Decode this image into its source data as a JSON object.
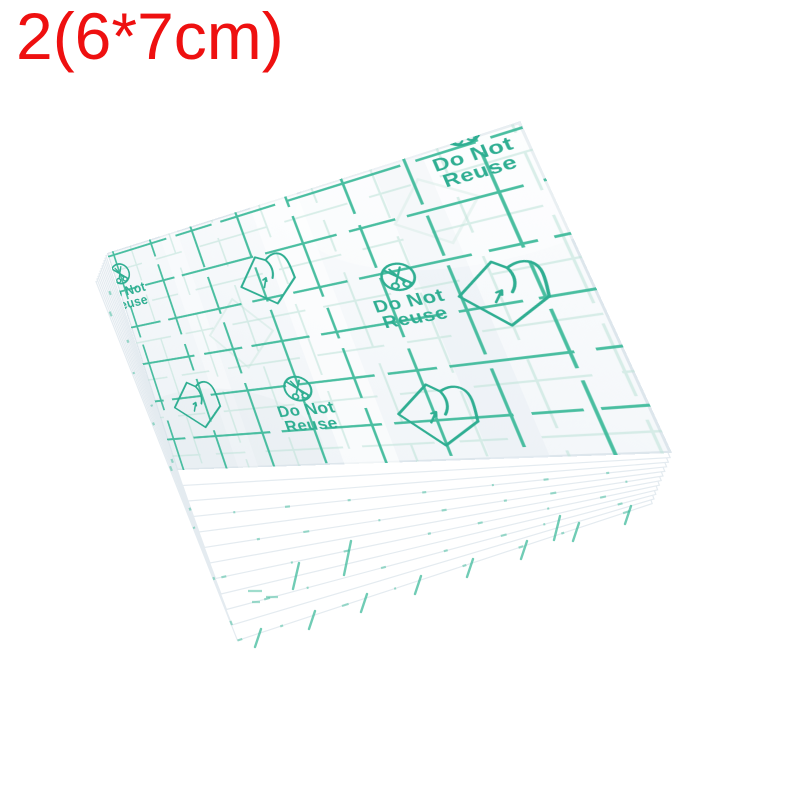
{
  "size_label": {
    "text": "2(6*7cm)"
  },
  "film": {
    "warning_line1": "Do Not",
    "warning_line2": "Reuse",
    "warning_count": 4,
    "peel_icon_count": 4
  },
  "colors": {
    "label-red": "#ee1010",
    "grid-teal": "#40bb9c",
    "print-teal": "#2fae92",
    "ghost-teal": "#bde3d8",
    "film-bg": "#f1f5f8",
    "layer-edge": "#e4ebf0"
  }
}
